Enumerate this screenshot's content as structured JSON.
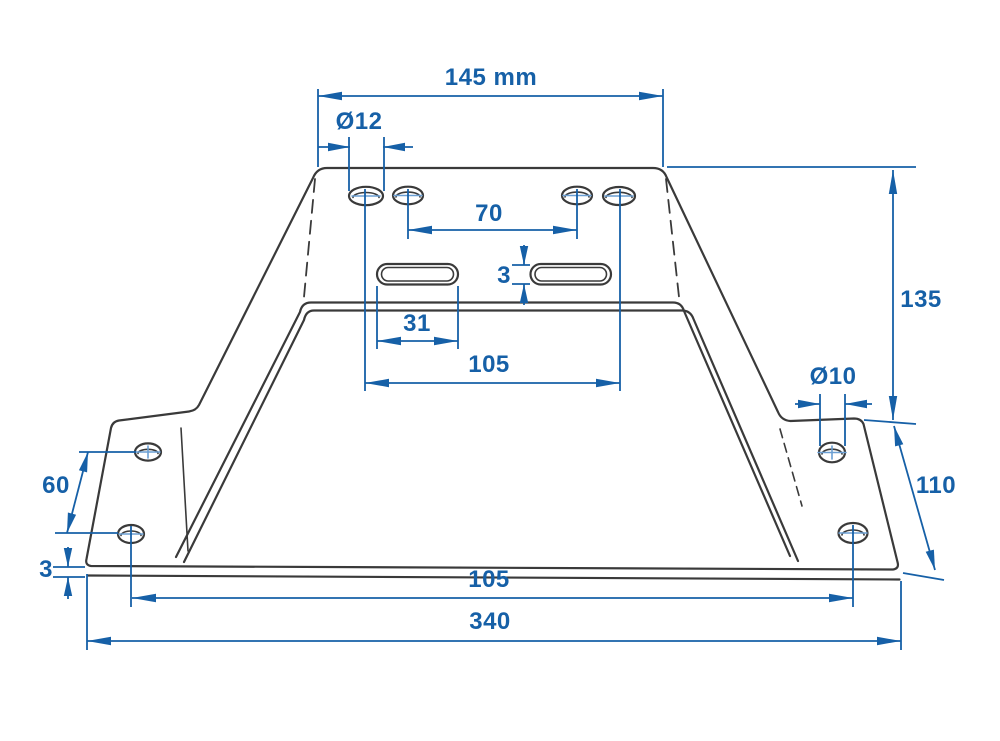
{
  "drawing": {
    "type": "technical-dimension-drawing",
    "part": "trapezoidal mounting bracket, front view with flared side wings",
    "background_color": "#ffffff",
    "outline_color": "#3a3a3a",
    "dimension_color": "#1660a7",
    "units": "mm",
    "labels": {
      "top_width": "145 mm",
      "top_hole_diameter": "Ø12",
      "top_hole_inner_spacing": "70",
      "slot_height": "3",
      "slot_length": "31",
      "top_hole_outer_spacing": "105",
      "overall_height": "135",
      "wing_hole_diameter": "Ø10",
      "wing_length": "110",
      "wing_hole_spacing": "60",
      "material_thickness": "3",
      "bottom_hole_spacing": "105",
      "overall_width": "340"
    },
    "features": {
      "top_holes": 4,
      "slots": 2,
      "left_wing_holes": 2,
      "right_wing_holes": 2
    }
  }
}
